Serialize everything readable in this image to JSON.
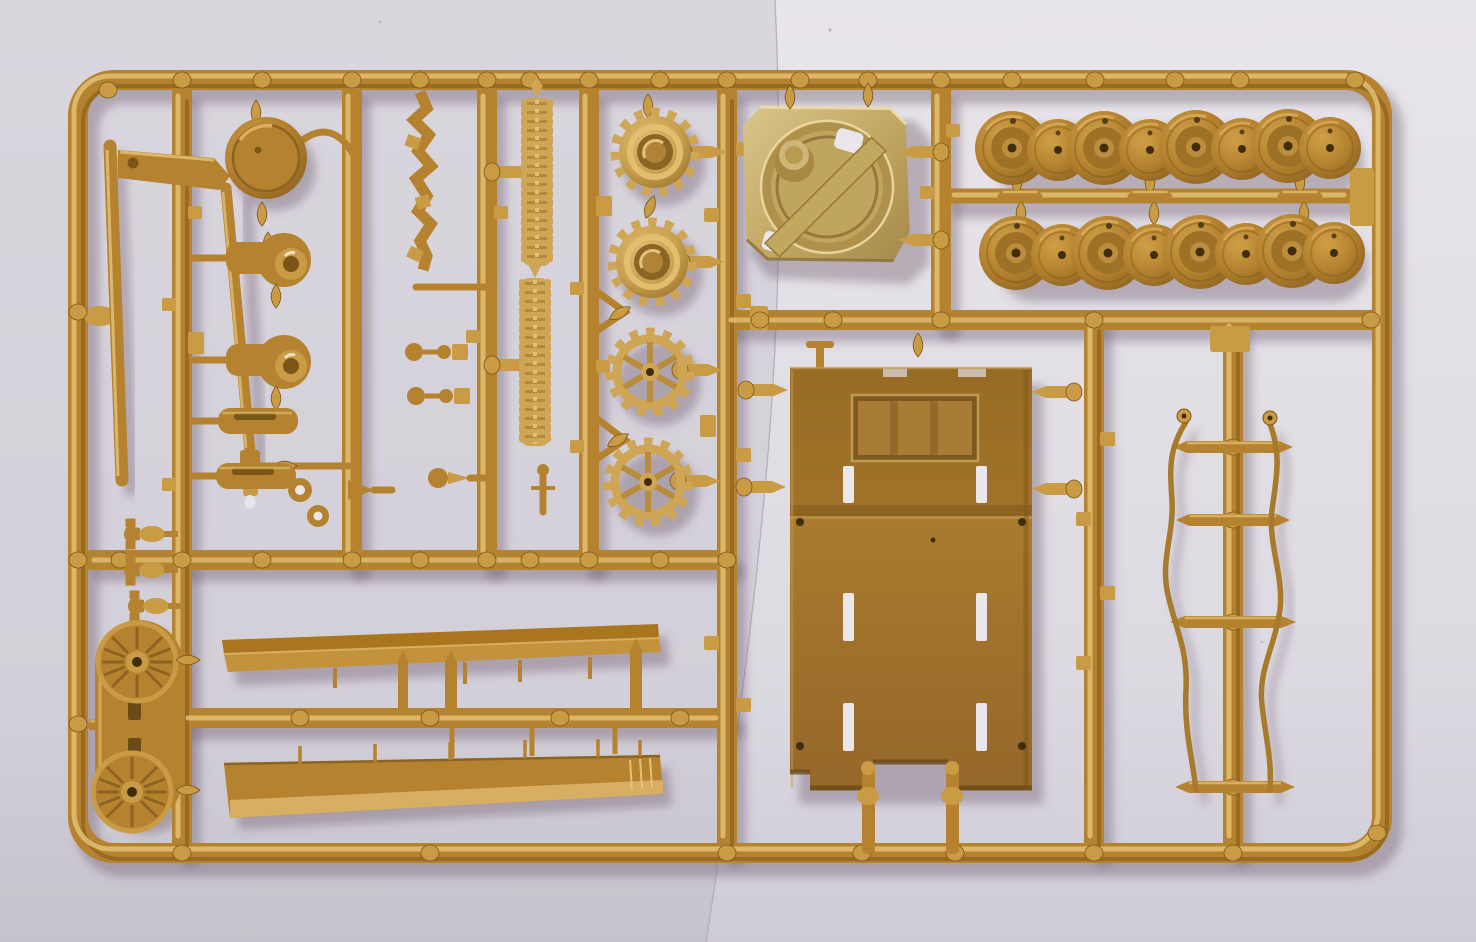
{
  "scene": {
    "type": "photograph",
    "subject": "Injection-molded plastic model kit sprue (parts tree) in sand-tan styrene photographed on pale grey paper",
    "orientation": "landscape",
    "lighting": "warm light from upper left with soft drop shadows falling to the lower right",
    "background": "two sheets of pale lavender-grey paper with a faint near-vertical seam right of center"
  },
  "colors": {
    "bg-left": "#d7d3db",
    "bg-left-low": "#c9c5ce",
    "bg-right": "#e6e3e9",
    "bg-right-low": "#d2ced7",
    "seam": "#b4aeb8",
    "plastic-mid": "#b5832f",
    "plastic-light": "#c99b45",
    "plastic-hi": "#e6c478",
    "plastic-dk": "#7a5515",
    "plastic-pale": "#cfa556",
    "pale-hi": "#e4c172",
    "turret-pale": "#c9b070",
    "turret-hi": "#ecdca6",
    "hull-face": "#a5762c",
    "hull-dark": "#8d6322",
    "hole-dark": "#402d0e",
    "paper-through": "#e9e6ec",
    "shadow": "rgba(104,88,102,0.38)"
  },
  "sprue": {
    "material": "tan styrene plastic",
    "frame_shape": "rounded rectangle with internal runners",
    "parts": [
      {
        "id": "road-wheels",
        "label": "Road wheels",
        "count": 16,
        "note": "two rows of eight, alternating dished and flat faces"
      },
      {
        "id": "drive-sprockets",
        "label": "Drive sprockets",
        "count": 4,
        "note": "toothed; two solid-hub, two six-spoke"
      },
      {
        "id": "idler-wheels",
        "label": "Spoked idler wheels on carrier plate",
        "count": 2
      },
      {
        "id": "turret-ring-base",
        "label": "Turret ring base plate with filler cylinder",
        "count": 1
      },
      {
        "id": "hull-bottom-plate",
        "label": "Hull belly plate with grille recess, slots and holes",
        "count": 1
      },
      {
        "id": "gun-barrel",
        "label": "Gun barrel with muzzle brake",
        "count": 1
      },
      {
        "id": "long-rod",
        "label": "Plain long barrel rod",
        "count": 1
      },
      {
        "id": "barrel-bracket",
        "label": "Barrel mounting bracket",
        "count": 1
      },
      {
        "id": "round-hatch",
        "label": "Round hatch lid",
        "count": 1
      },
      {
        "id": "final-drive-housings",
        "label": "Final drive housings",
        "count": 2
      },
      {
        "id": "exhaust-mufflers",
        "label": "Slotted cylinder mufflers",
        "count": 2
      },
      {
        "id": "track-link-strips",
        "label": "Textured track-link strips",
        "count": 2
      },
      {
        "id": "link-chain",
        "label": "Zig-zag chain of small links",
        "count": 1
      },
      {
        "id": "dumbbell-pins",
        "label": "Stepped dumbbell pins",
        "count": 2
      },
      {
        "id": "fender-blades",
        "label": "Long fender blades",
        "count": 2
      },
      {
        "id": "tow-hooks",
        "label": "Tow shackles",
        "count": 3
      },
      {
        "id": "tow-cables",
        "label": "Thin wavy tow cables",
        "count": 2
      },
      {
        "id": "torsion-spindles",
        "label": "Pointed cross spindles",
        "count": 4
      },
      {
        "id": "small-fittings",
        "label": "Assorted small fittings and knobs",
        "count": 12
      },
      {
        "id": "sprue-frame",
        "label": "Sprue frame and runners",
        "count": 1
      }
    ]
  }
}
